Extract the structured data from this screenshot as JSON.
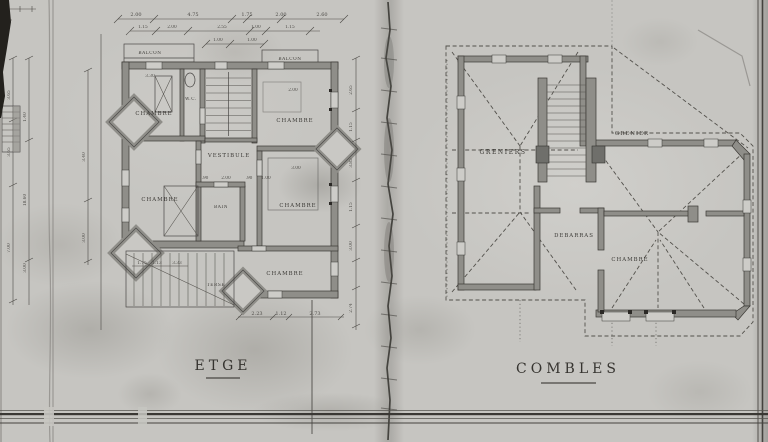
{
  "sheet": {
    "left_title": "ETGE",
    "right_title": "COMBLES"
  },
  "left_plan": {
    "labels": {
      "balcon_left": "BALCON",
      "balcon_right": "BALCON",
      "chambre_top_left": "CHAMBRE",
      "chambre_top_right": "CHAMBRE",
      "wc": "W.C.",
      "vestibule": "VESTIBULE",
      "chambre_mid_left": "CHAMBRE",
      "bain": "BAIN",
      "chambre_mid_right": "CHAMBRE",
      "chambre_bottom": "CHAMBRE",
      "terrasse": "TERSE"
    },
    "dims_top_row1": [
      "2.00",
      "4.75",
      "1.75",
      "2.00",
      "2.60"
    ],
    "dims_top_row2": [
      "1.15",
      "2.00",
      "2.55",
      "1.00",
      "1.15"
    ],
    "dims_top_row3": [
      "1.00",
      "1.00"
    ],
    "dims_bottom": [
      "2.23",
      "1.12",
      "2.73"
    ],
    "dims_terrace": [
      "1.75",
      "1.13",
      "3.33"
    ],
    "dims_interior": [
      "3.30",
      "2.00",
      "3.00",
      ".90",
      "2.00",
      ".90",
      "1.00"
    ],
    "dims_left_chain1": [
      "3.65",
      "3.65",
      "7.00"
    ],
    "dims_left_chain2": [
      "1.40",
      "18.60",
      "3.00"
    ],
    "dims_left_chain3": [
      "3.40",
      "3.00"
    ],
    "dims_middle": [
      "2.65",
      "1.15",
      "3.85",
      "1.15",
      "3.00",
      "2.74"
    ]
  },
  "right_plan": {
    "labels": {
      "greniers": "GRENIERS",
      "grenier": "GRENIER",
      "debarras": "DEBARRAS",
      "chambre": "CHAMBRE"
    }
  }
}
